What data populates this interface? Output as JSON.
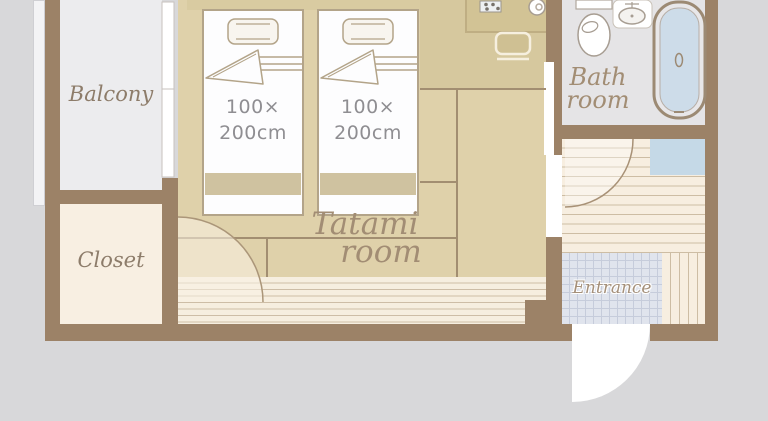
{
  "diagram_type": "hotel-room-floor-plan",
  "rooms": {
    "balcony": {
      "label": "Balcony"
    },
    "closet": {
      "label": "Closet"
    },
    "tatami_room": {
      "label_line1": "Tatami",
      "label_line2": "room"
    },
    "bathroom": {
      "label_line1": "Bath",
      "label_line2": "room"
    },
    "entrance": {
      "label": "Entrance"
    }
  },
  "beds": [
    {
      "name": "single-bed-left",
      "size_line1": "100×",
      "size_line2": "200cm"
    },
    {
      "name": "single-bed-right",
      "size_line1": "100×",
      "size_line2": "200cm"
    }
  ],
  "fixtures": [
    "stove-icon",
    "kettle-icon",
    "stool-icon",
    "toilet-icon",
    "sink-icon",
    "bathtub-icon",
    "washing-machine-space",
    "pillow-icon",
    "door-swing-arc",
    "sliding-window",
    "entrance-door-swing"
  ],
  "colors": {
    "outside": "#d8d8da",
    "wall": "#9c8267",
    "tatami": "#dfd1aa",
    "wood_floor": "#d6c89e",
    "counter": "#d2c395",
    "engawa": "#f6eedf",
    "balcony_floor": "#ececee",
    "closet_floor": "#f8efe2",
    "bathroom_floor": "#e5e4e6",
    "bath_water": "#cddce9",
    "washer_space_blue": "#c5d9e7",
    "entrance_tile": "#e0e4ed",
    "label_brown": "#8d7c6a"
  }
}
